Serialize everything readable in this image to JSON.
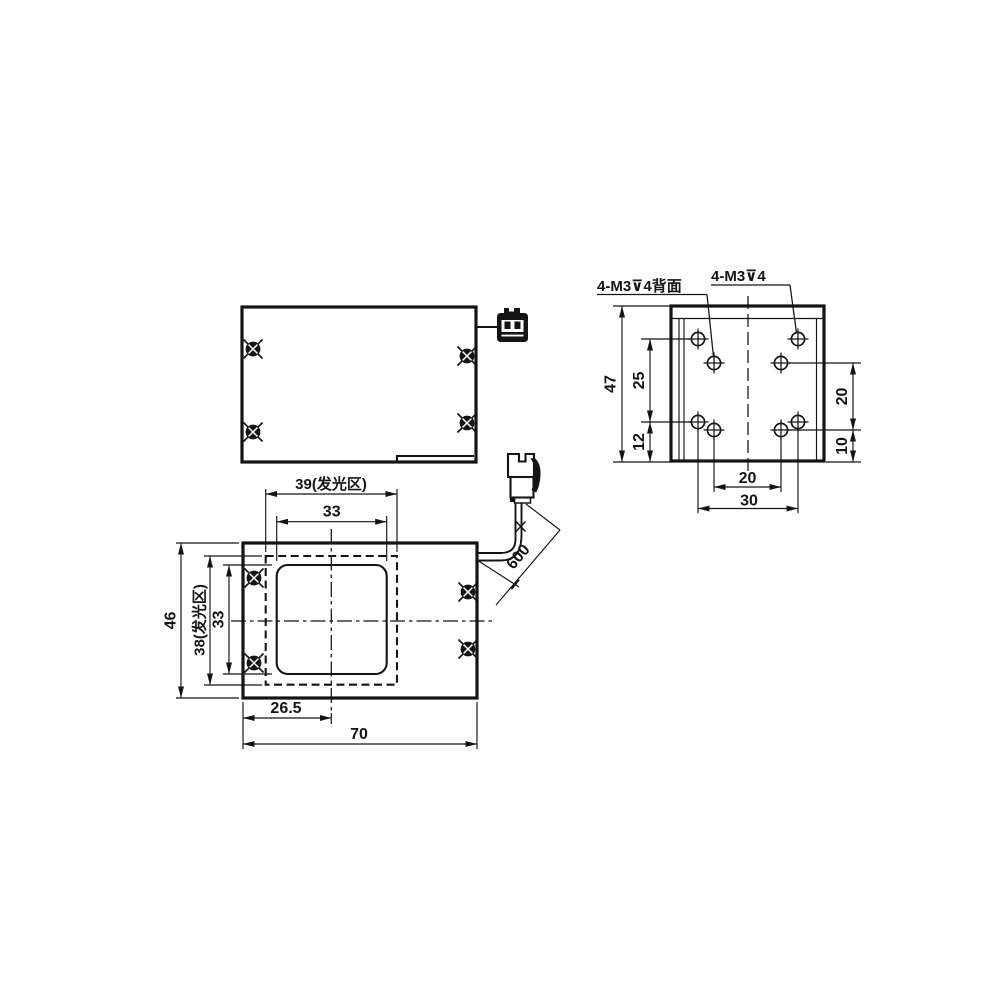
{
  "drawing": {
    "back_view": {
      "label_back_holes": "4-M3⊽4背面",
      "label_top_holes": "4-M3⊽4",
      "dims": {
        "overall_height": "47",
        "outer_row_spacing": "25",
        "outer_row_bottom_offset": "12",
        "inner_row_spacing": "20",
        "inner_row_bottom_offset": "10",
        "inner_col_spacing": "20",
        "outer_col_spacing": "30"
      }
    },
    "front_view": {
      "dims": {
        "emitting_area_width": "39(发光区)",
        "window_width": "33",
        "overall_height": "46",
        "emitting_area_height": "38(发光区)",
        "window_height": "33",
        "center_offset": "26.5",
        "overall_width": "70"
      }
    },
    "cable": {
      "dims": {
        "length": "600"
      }
    }
  }
}
